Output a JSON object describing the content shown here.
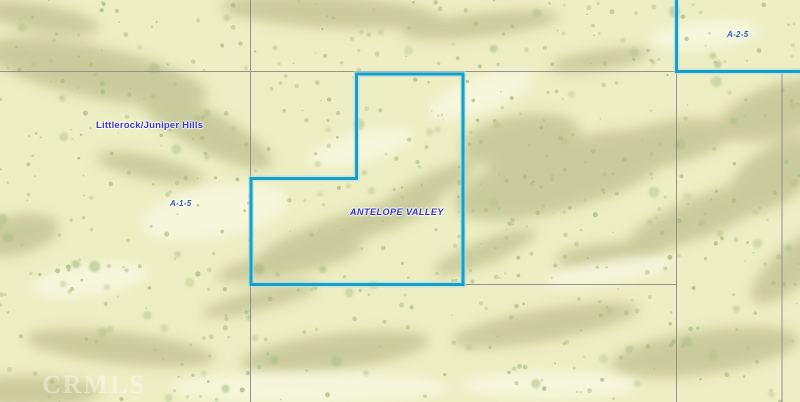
{
  "map": {
    "labels": {
      "community": "Littlerock/Juniper Hills",
      "valley": "ANTELOPE VALLEY",
      "zoning_left": "A-1-5",
      "zoning_right": "A-2-5"
    },
    "watermark_text": "CRMLS",
    "colors": {
      "terrain_base": "#edeec3",
      "terrain_shade": "#c5c696",
      "vegetation_speckle": "#a9bd83",
      "terrain_highlight": "#f7f8e0",
      "parcel_boundary_highlight": "#14a0c8",
      "parcel_boundary_glow": "#a9dcea",
      "parcel_grid_line": "#8a8890",
      "place_label_blue": "#3b3bd0",
      "zoning_label_blue": "#2d5ea8"
    }
  }
}
